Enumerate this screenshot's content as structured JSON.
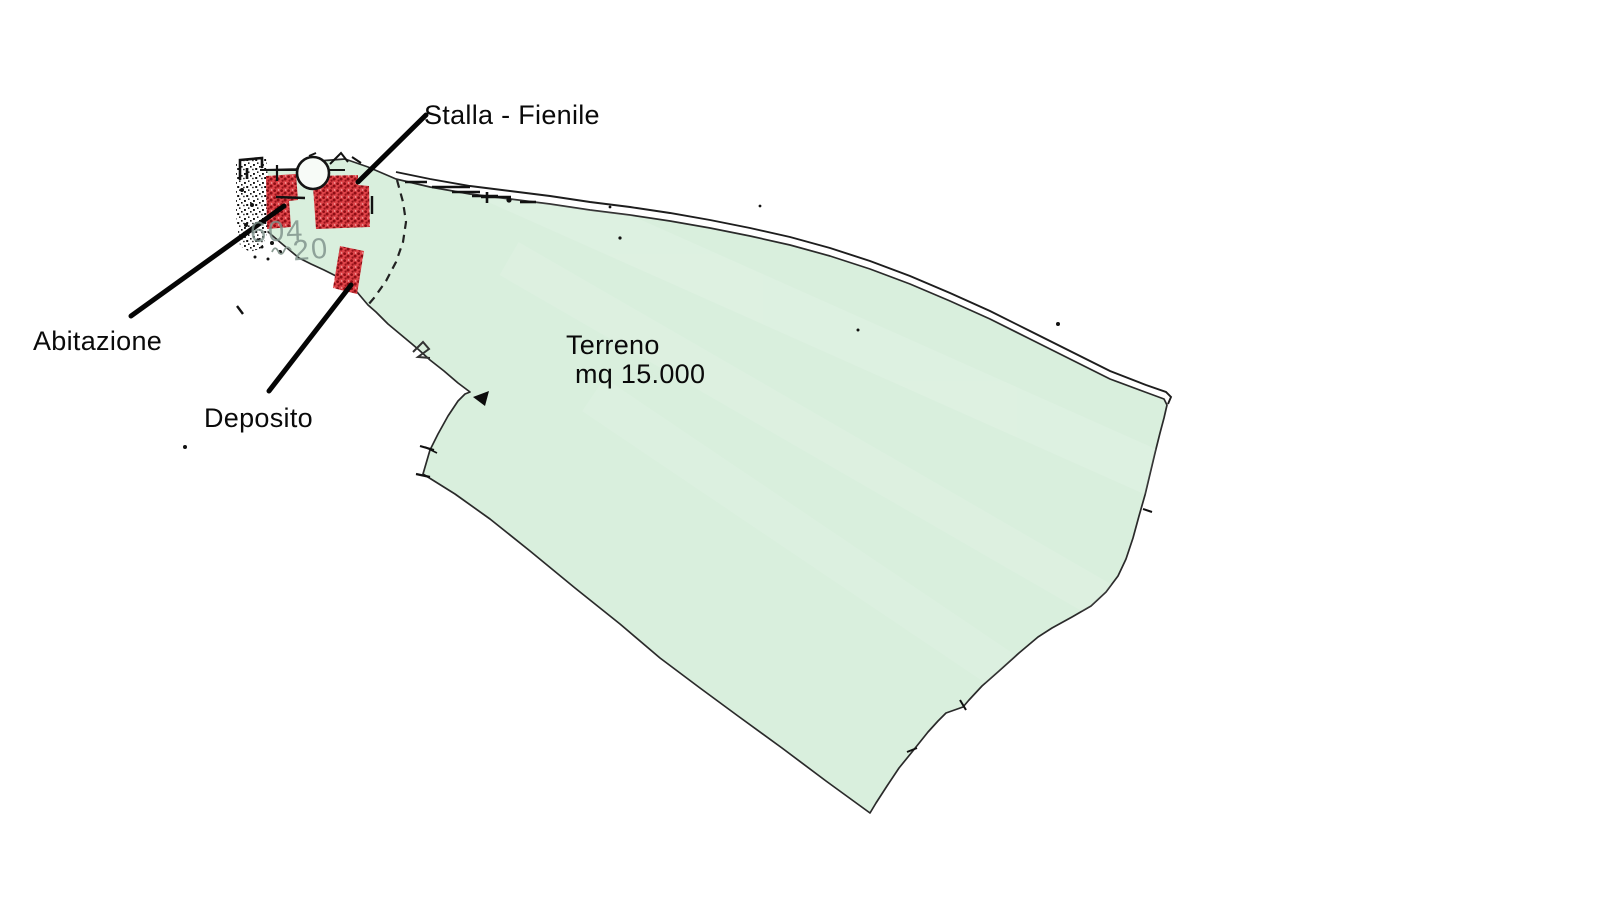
{
  "map": {
    "annotations": {
      "stalla": "Stalla - Fienile",
      "abitazione": "Abitazione",
      "deposito": "Deposito",
      "terreno_name": "Terreno",
      "terreno_area": "mq 15.000"
    },
    "parcel_numbers": {
      "upper": "604",
      "lower": "20"
    },
    "colors": {
      "background": "#ffffff",
      "land_fill": "#d9efdd",
      "boundary_line": "#2a2a2a",
      "building_fill": "#de4348",
      "building_dots": "#8e0e15",
      "label_text": "#0a0a0a",
      "parcel_number_text": "#7e928b"
    }
  }
}
